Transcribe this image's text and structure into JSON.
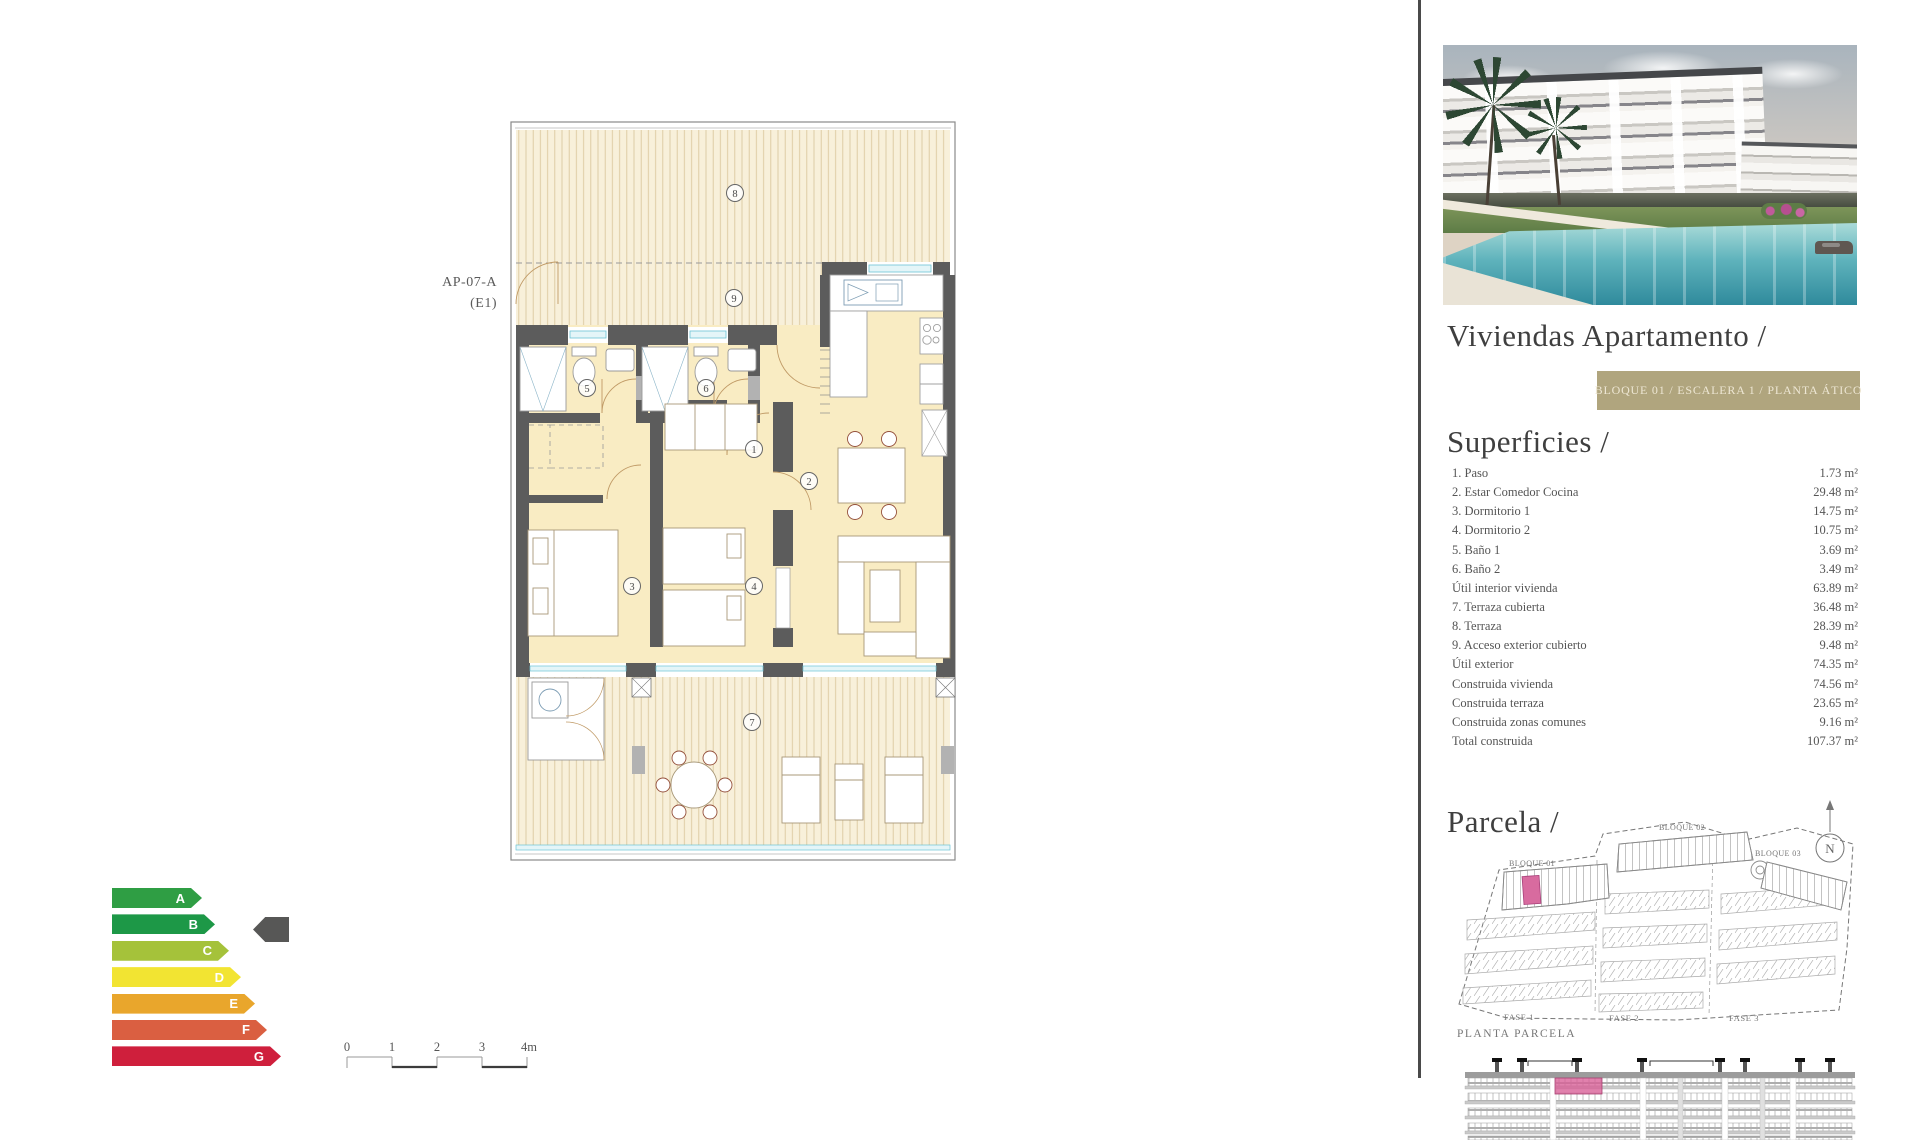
{
  "plan": {
    "unit_code": "AP-07-A",
    "unit_sub": "(E1)",
    "rooms": [
      "1",
      "2",
      "3",
      "4",
      "5",
      "6",
      "7",
      "8",
      "9"
    ]
  },
  "sidebar": {
    "title": "Viviendas Apartamento /",
    "badge": "BLOQUE 01 / ESCALERA 1 / PLANTA ÁTICO",
    "superficies": {
      "heading": "Superficies /",
      "items": [
        {
          "label": "1. Paso",
          "value": "1.73 m²"
        },
        {
          "label": "2. Estar Comedor Cocina",
          "value": "29.48 m²"
        },
        {
          "label": "3. Dormitorio 1",
          "value": "14.75 m²"
        },
        {
          "label": "4. Dormitorio 2",
          "value": "10.75 m²"
        },
        {
          "label": "5. Baño 1",
          "value": "3.69 m²"
        },
        {
          "label": "6. Baño 2",
          "value": "3.49 m²"
        },
        {
          "label": "Útil interior vivienda",
          "value": "63.89 m²"
        },
        {
          "label": "7. Terraza cubierta",
          "value": "36.48 m²"
        },
        {
          "label": "8. Terraza",
          "value": "28.39 m²"
        },
        {
          "label": "9. Acceso exterior cubierto",
          "value": "9.48 m²"
        },
        {
          "label": "Útil exterior",
          "value": "74.35 m²"
        },
        {
          "label": "Construida vivienda",
          "value": "74.56 m²"
        },
        {
          "label": "Construida terraza",
          "value": "23.65 m²"
        },
        {
          "label": "Construida zonas comunes",
          "value": "9.16 m²"
        },
        {
          "label": "Total construida",
          "value": "107.37 m²"
        }
      ]
    },
    "parcela": {
      "heading": "Parcela /",
      "north_label": "N",
      "bloque_labels": [
        "BLOQUE 01",
        "BLOQUE 02",
        "BLOQUE 03"
      ],
      "fase_labels": [
        "FASE 1",
        "FASE 2",
        "FASE 3"
      ],
      "caption": "PLANTA PARCELA"
    }
  },
  "energy_label": {
    "selected_grade": "B",
    "pointer_color": "#575756",
    "grades": [
      {
        "letter": "A",
        "color": "#2f9e44"
      },
      {
        "letter": "B",
        "color": "#1d9847"
      },
      {
        "letter": "C",
        "color": "#a5c23a"
      },
      {
        "letter": "D",
        "color": "#f2e432"
      },
      {
        "letter": "E",
        "color": "#e9a62c"
      },
      {
        "letter": "F",
        "color": "#da5f41"
      },
      {
        "letter": "G",
        "color": "#cf1f3c"
      }
    ]
  },
  "scale_bar": {
    "ticks": [
      "0",
      "1",
      "2",
      "3",
      "4m"
    ]
  },
  "colors": {
    "accent_pink": "#d86b9f",
    "badge_bg": "#b0a57e",
    "wall": "#5c5c5c",
    "floor": "#f9ecc3",
    "deck": "#f8f0da",
    "glazing": "#6cc3d4",
    "divider": "#4a4a4a"
  }
}
